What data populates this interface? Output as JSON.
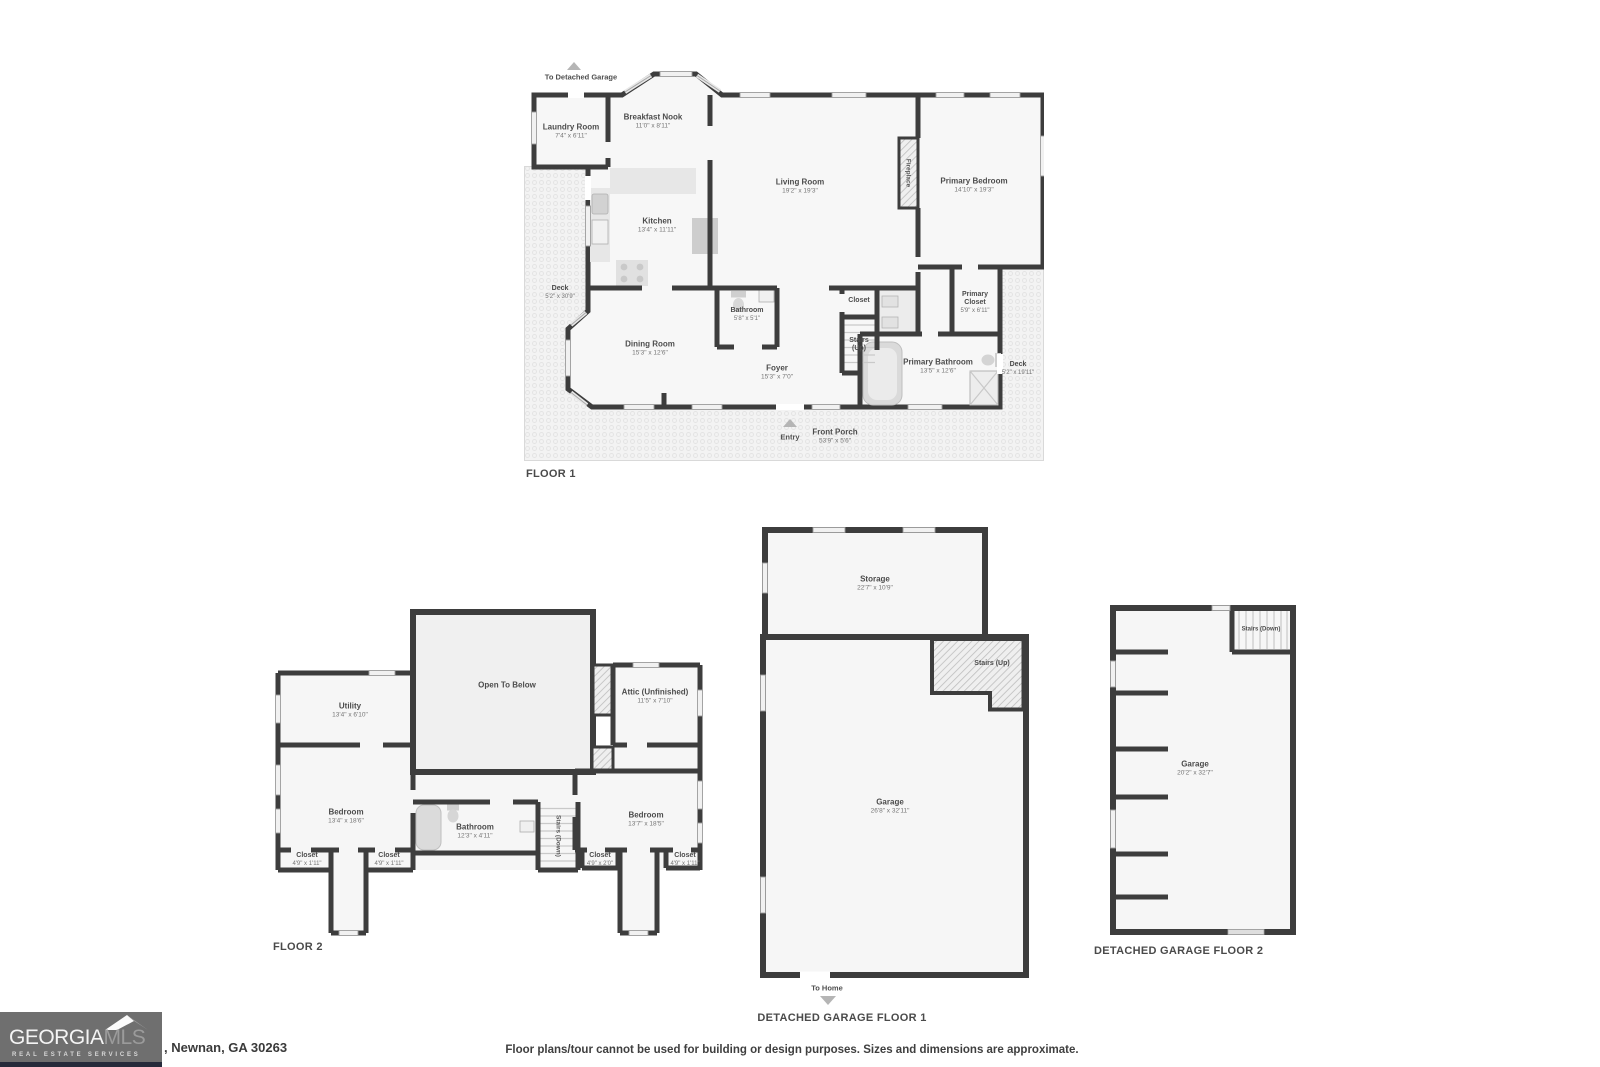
{
  "page": {
    "disclaimer": "Floor plans/tour cannot be used for building or design purposes. Sizes and dimensions are approximate.",
    "address": ", Newnan, GA 30263",
    "logo": {
      "brand_primary": "GEORGIA",
      "brand_secondary": "MLS",
      "tagline": "REAL ESTATE SERVICES"
    },
    "colors": {
      "wall": "#3d3d3d",
      "room_fill": "#f7f7f7",
      "deck_fill": "#f3f3f3",
      "arrow_gray": "#b5b5b5",
      "logo_box": "#6f6f6f",
      "logo_strip": "#262b3b",
      "label_text": "#4c4c4c"
    }
  },
  "floor1": {
    "title": "FLOOR 1",
    "annotations": {
      "to_garage": "To Detached Garage",
      "entry": "Entry",
      "fireplace": "Fireplace"
    },
    "rooms": {
      "laundry": {
        "name": "Laundry Room",
        "dims": "7'4\" x 6'11\""
      },
      "breakfast_nook": {
        "name": "Breakfast Nook",
        "dims": "11'0\" x 8'11\""
      },
      "living_room": {
        "name": "Living Room",
        "dims": "19'2\" x 19'3\""
      },
      "primary_bedroom": {
        "name": "Primary Bedroom",
        "dims": "14'10\" x 19'3\""
      },
      "kitchen": {
        "name": "Kitchen",
        "dims": "13'4\" x 11'11\""
      },
      "deck_left": {
        "name": "Deck",
        "dims": "5'2\" x 30'9\""
      },
      "dining_room": {
        "name": "Dining Room",
        "dims": "15'3\" x 12'6\""
      },
      "bathroom": {
        "name": "Bathroom",
        "dims": "5'8\" x 5'1\""
      },
      "closet": {
        "name": "Closet"
      },
      "stairs": {
        "name": "Stairs",
        "direction": "(Up)"
      },
      "primary_closet": {
        "name": "Primary Closet",
        "dims": "5'9\" x 6'11\""
      },
      "primary_bathroom": {
        "name": "Primary Bathroom",
        "dims": "13'5\" x 12'6\""
      },
      "deck_right": {
        "name": "Deck",
        "dims": "5'2\" x 19'11\""
      },
      "foyer": {
        "name": "Foyer",
        "dims": "15'3\" x 7'0\""
      },
      "front_porch": {
        "name": "Front Porch",
        "dims": "53'9\" x 5'6\""
      }
    }
  },
  "floor2": {
    "title": "FLOOR 2",
    "rooms": {
      "utility": {
        "name": "Utility",
        "dims": "13'4\" x 6'10\""
      },
      "open_to_below": {
        "name": "Open To Below"
      },
      "attic": {
        "name": "Attic (Unfinished)",
        "dims": "11'5\" x 7'10\""
      },
      "bedroom_left": {
        "name": "Bedroom",
        "dims": "13'4\" x 18'6\""
      },
      "bathroom": {
        "name": "Bathroom",
        "dims": "12'3\" x 4'11\""
      },
      "stairs": {
        "name": "Stairs (Down)"
      },
      "bedroom_right": {
        "name": "Bedroom",
        "dims": "13'7\" x 18'5\""
      },
      "closet_left_1": {
        "name": "Closet",
        "dims": "4'9\" x 1'11\""
      },
      "closet_left_2": {
        "name": "Closet",
        "dims": "4'9\" x 1'11\""
      },
      "closet_right_1": {
        "name": "Closet",
        "dims": "4'9\" x 2'0\""
      },
      "closet_right_2": {
        "name": "Closet",
        "dims": "4'9\" x 1'11\""
      }
    }
  },
  "garage_floor1": {
    "title": "DETACHED GARAGE FLOOR 1",
    "annotations": {
      "to_home": "To Home"
    },
    "rooms": {
      "storage": {
        "name": "Storage",
        "dims": "22'7\" x 10'9\""
      },
      "stairs": {
        "name": "Stairs (Up)"
      },
      "garage": {
        "name": "Garage",
        "dims": "26'8\" x 32'11\""
      }
    }
  },
  "garage_floor2": {
    "title": "DETACHED GARAGE FLOOR 2",
    "rooms": {
      "stairs": {
        "name": "Stairs (Down)"
      },
      "garage": {
        "name": "Garage",
        "dims": "20'2\" x 32'7\""
      }
    }
  }
}
